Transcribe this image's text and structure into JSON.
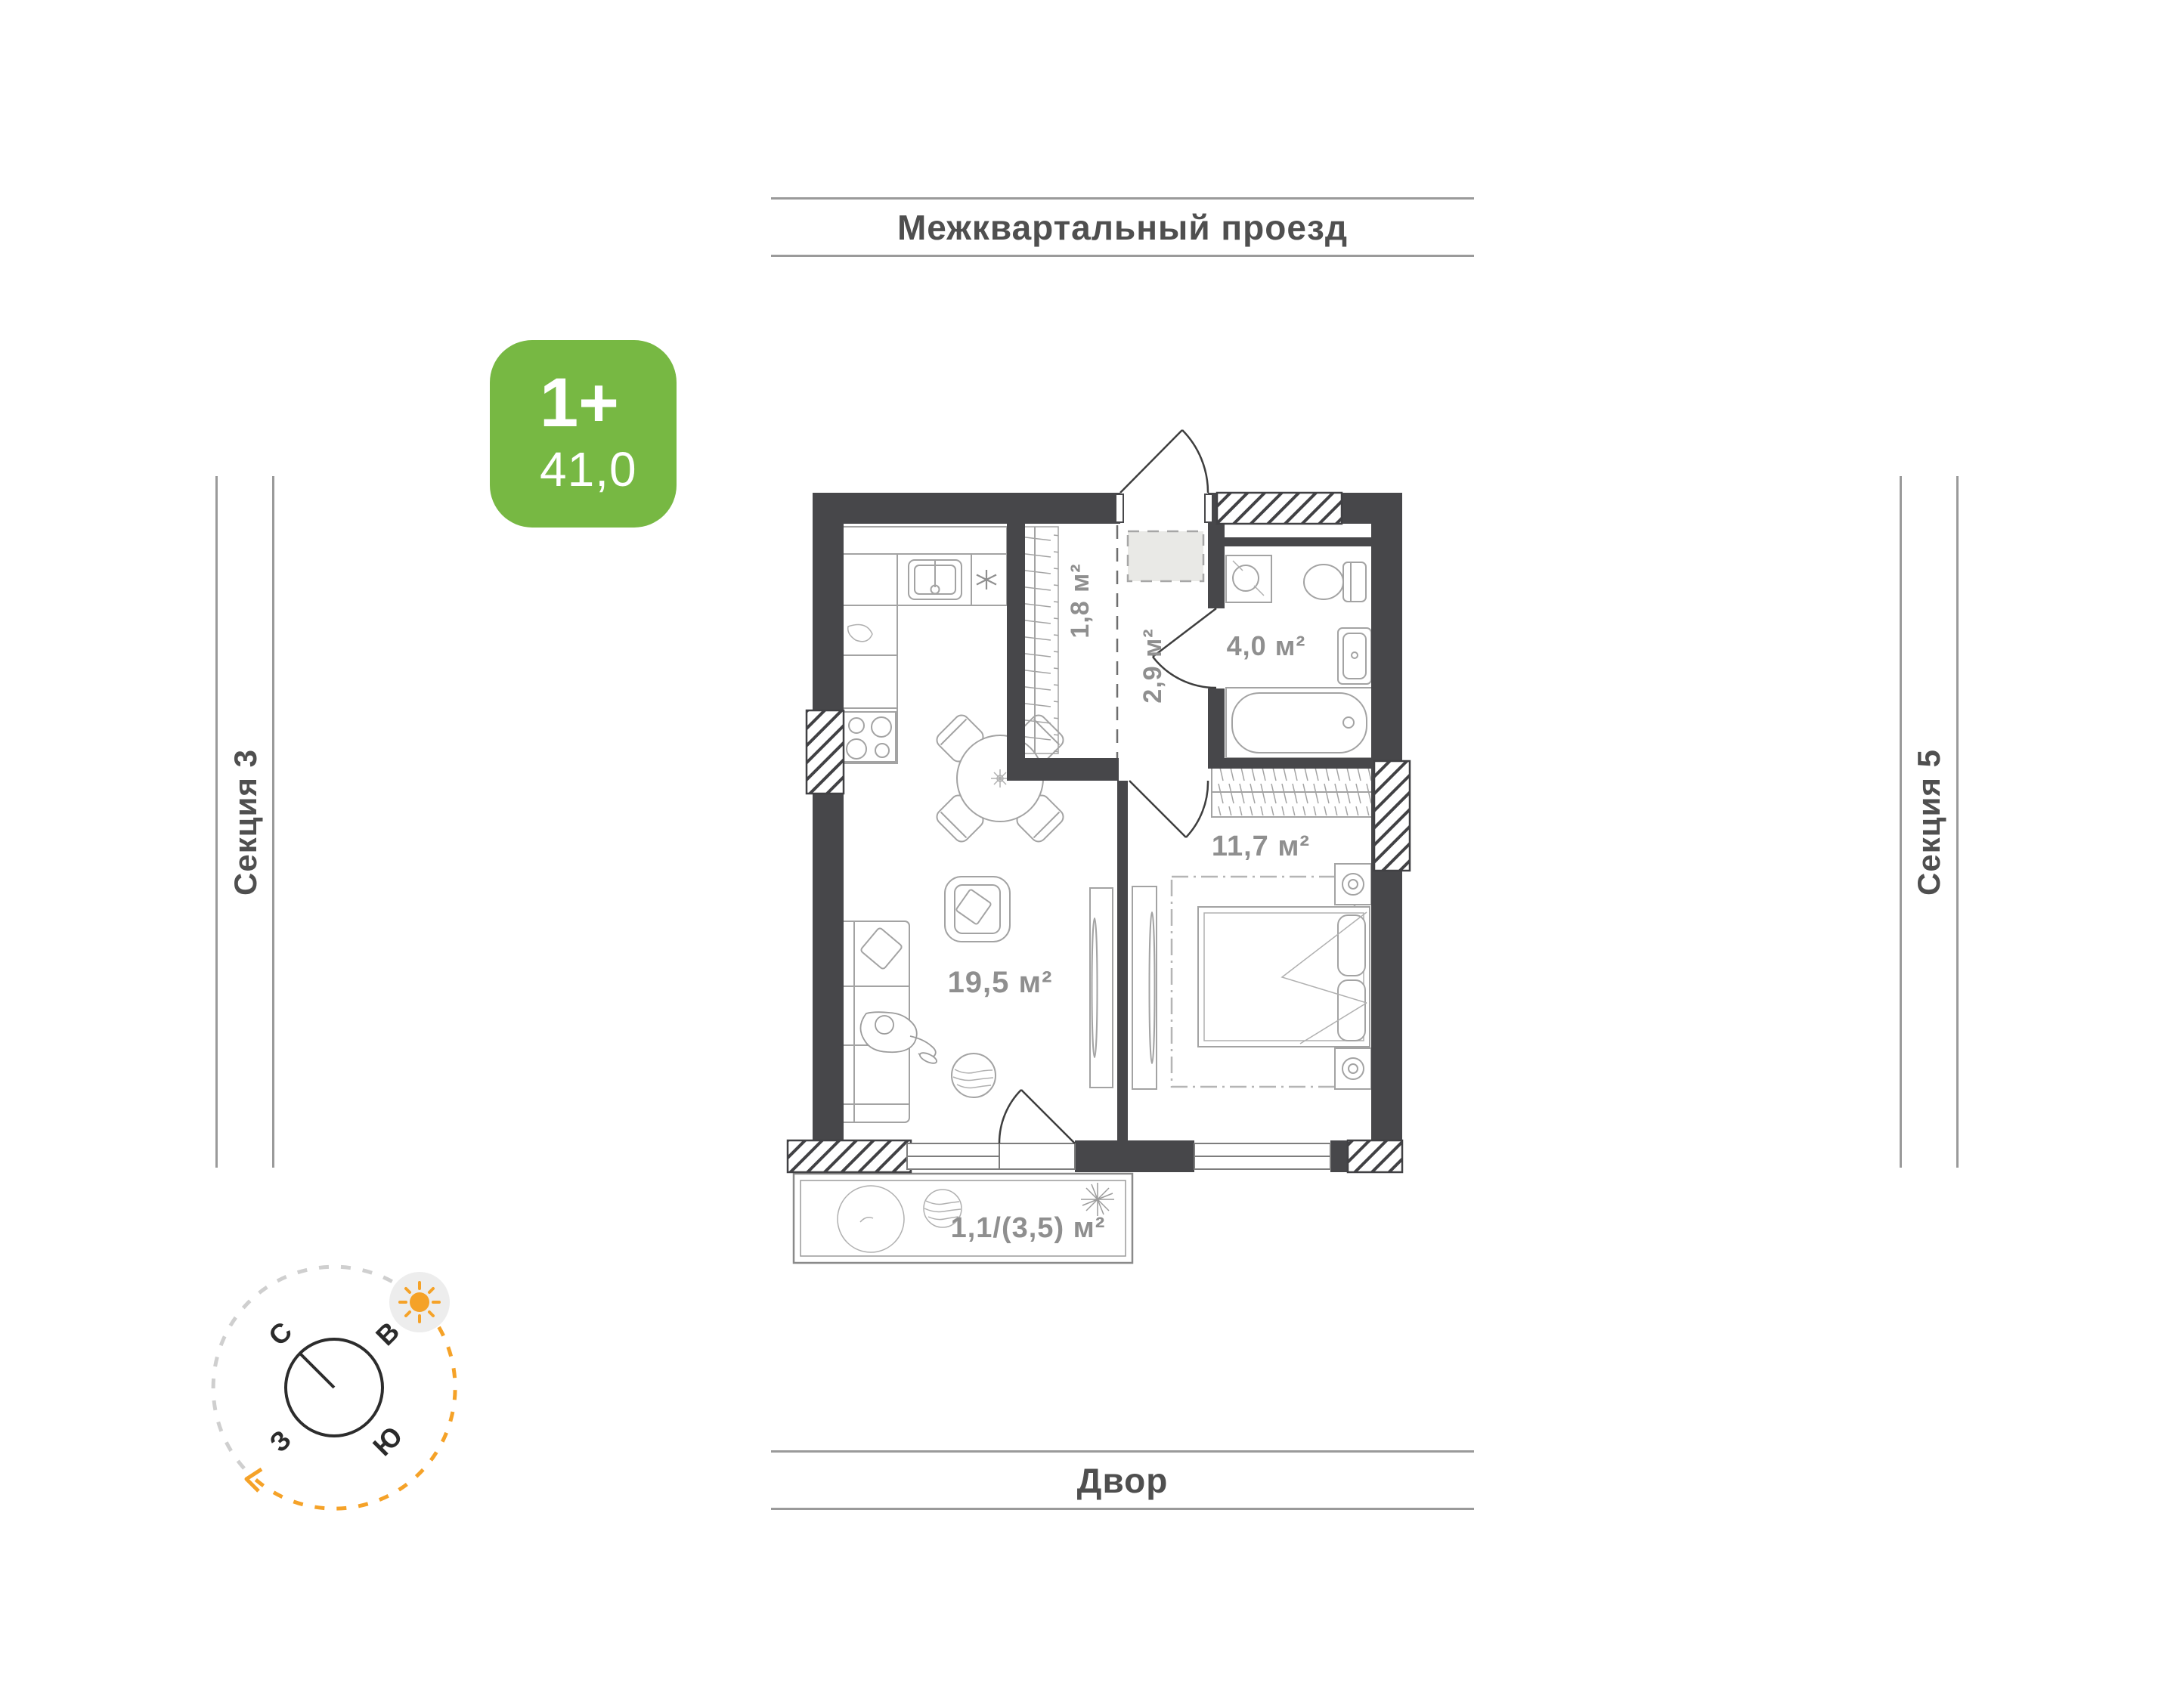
{
  "environment": {
    "street_label": "Межквартальный проезд",
    "yard_label": "Двор",
    "section_left_label": "Секция 3",
    "section_right_label": "Секция 5"
  },
  "apartment_badge": {
    "type_label": "1+",
    "total_area": "41,0"
  },
  "rooms": {
    "wardrobe": "1,8 м²",
    "hallway": "2,9 м²",
    "bathroom": "4,0 м²",
    "bedroom": "11,7 м²",
    "living_kitchen": "19,5 м²",
    "balcony": "1,1/(3,5) м²"
  },
  "compass": {
    "north": "С",
    "east": "В",
    "south": "Ю",
    "west": "З"
  },
  "colors": {
    "badge_green": "#77b843",
    "wall_dark": "#47474a",
    "label_gray": "#8f8f8f",
    "accent_orange": "#f5a228",
    "line_gray": "#9a9a9a"
  }
}
